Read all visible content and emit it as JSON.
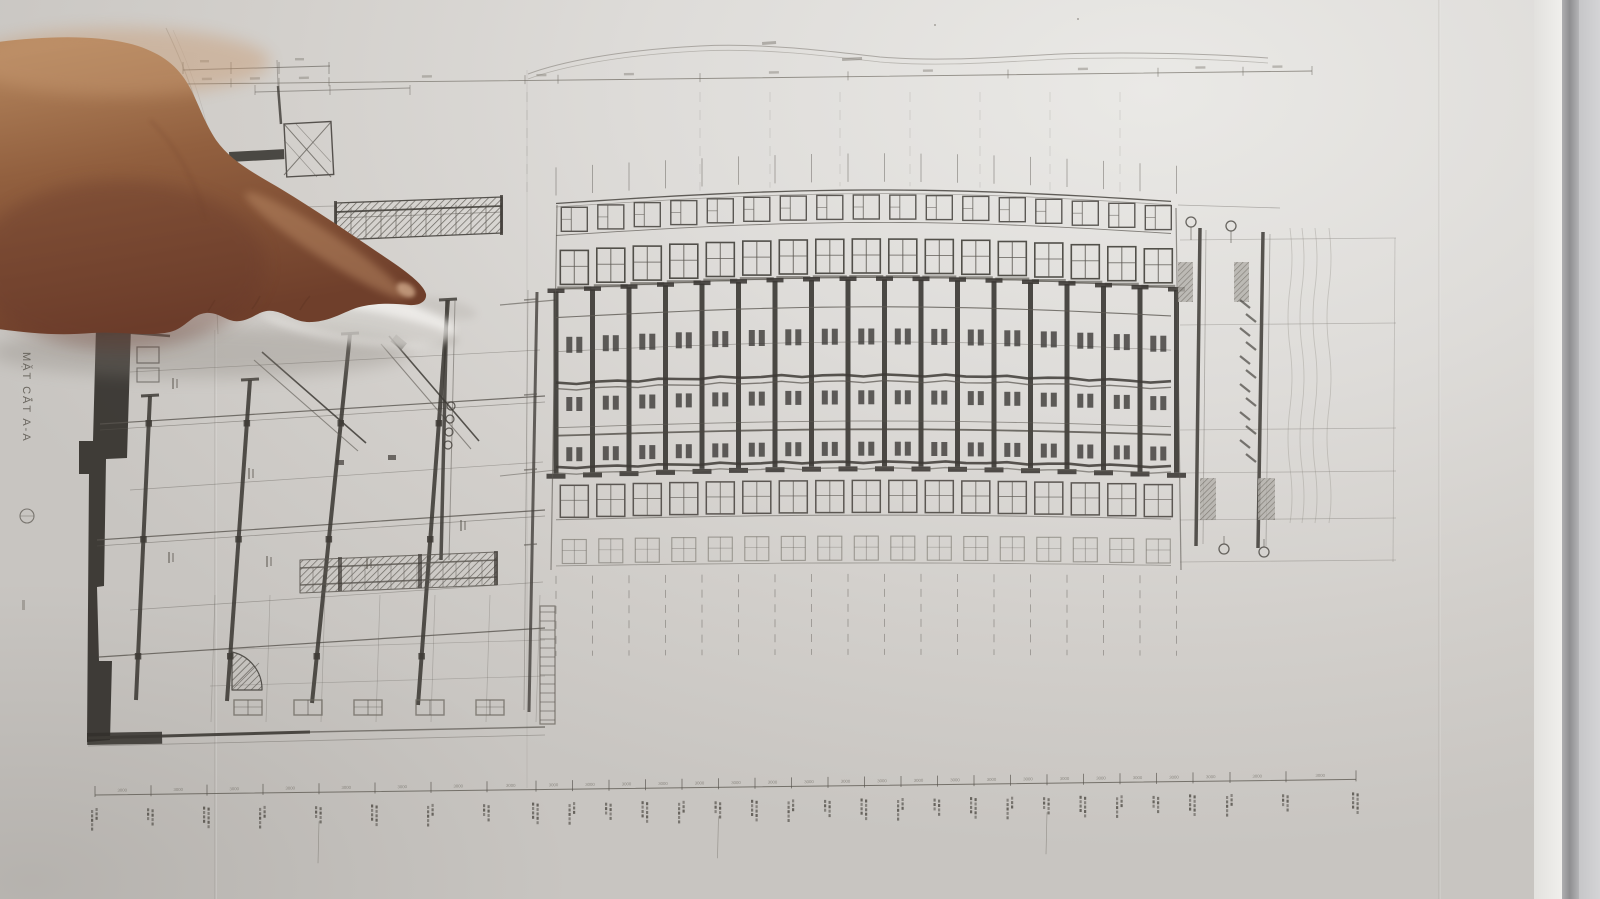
{
  "drawing": {
    "section_label": "MẶT CẮT A-A",
    "dim_value": "3000"
  },
  "colors": {
    "paper_light": "#eae9e6",
    "paper_mid": "#d7d5d1",
    "paper_dark": "#c8c5c1",
    "line": "#5a5650",
    "line_dark": "#3e3b36",
    "line_faint": "#8d8982",
    "poche": "#33302b",
    "dim_text": "#6f6b63",
    "skin_light": "#b88a61",
    "skin_mid": "#92603f",
    "skin_dark": "#6f3f2b",
    "nail": "#c9a183",
    "shadow": "#857f77",
    "glare": "#f4f3f0"
  }
}
